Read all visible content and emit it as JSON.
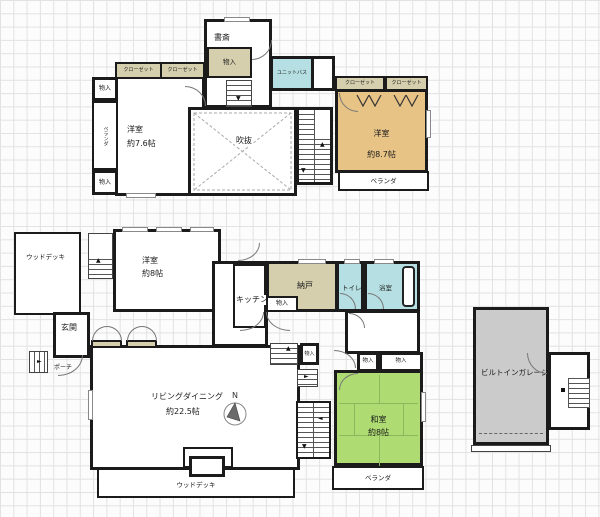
{
  "labels": {
    "study": "書斎",
    "storage": "物入",
    "closet": "クローゼット",
    "unit_bath": "ユニットバス",
    "western_room": "洋室",
    "atrium": "吹抜",
    "veranda": "ベランダ",
    "wood_deck": "ウッドデッキ",
    "entrance": "玄関",
    "porch": "ポーチ",
    "kitchen": "キッチン",
    "storeroom": "納戸",
    "toilet": "トイレ",
    "bathroom": "浴室",
    "living_dining": "リビングダイニング",
    "japanese_room": "和室",
    "garage": "ビルトインガレージ",
    "compass_north": "N"
  },
  "sizes": {
    "western_room_2f_left": "約7.6帖",
    "western_room_2f_right": "約8.7帖",
    "western_room_1f": "約8帖",
    "living_dining": "約22.5帖",
    "japanese_room": "約8帖"
  },
  "colors": {
    "wall": "#1b1b1b",
    "tan": "#d6cfae",
    "orange": "#e8c386",
    "cyan": "#b5dfe2",
    "green": "#aedc72",
    "gray": "#cbcbcb",
    "grid": "#e2e2e2",
    "paper": "#fcfcfc"
  }
}
